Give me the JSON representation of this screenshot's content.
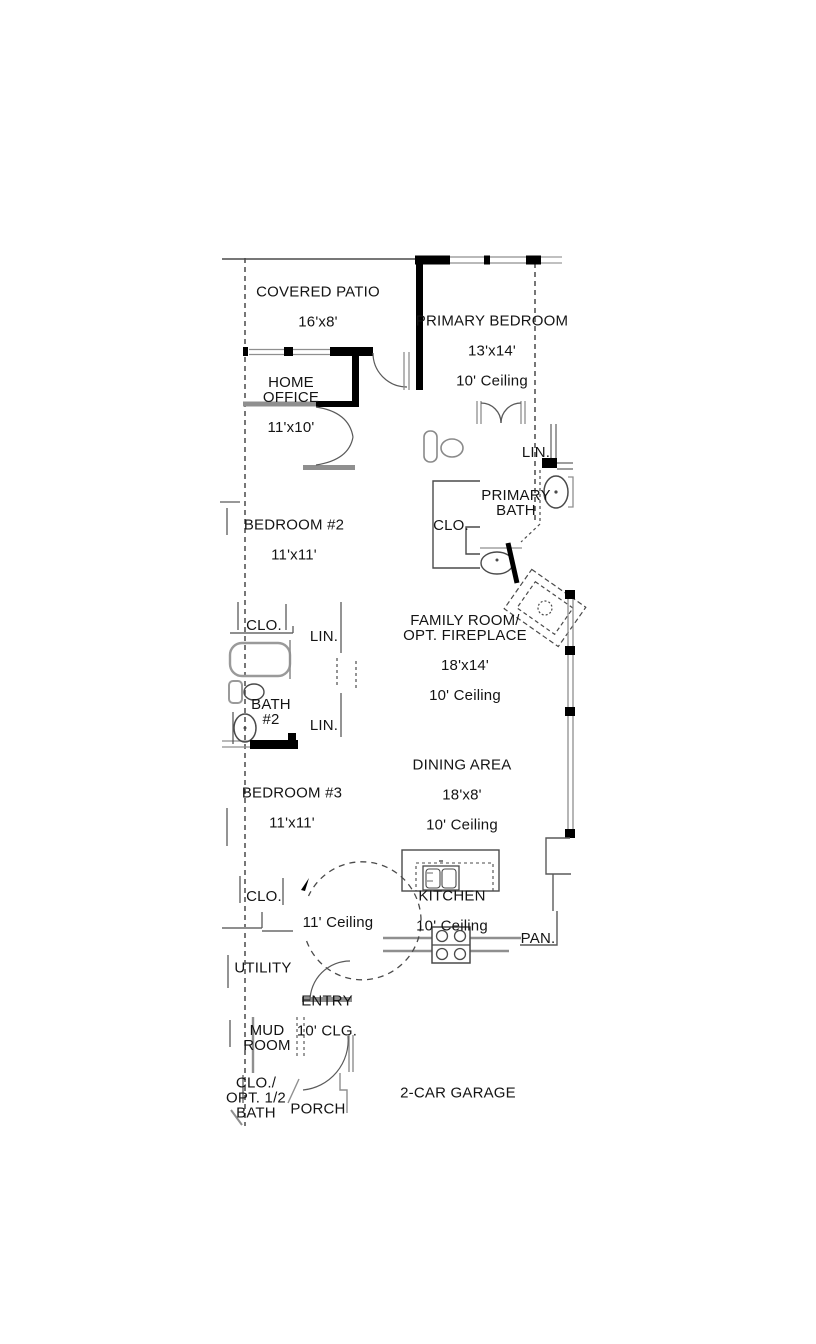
{
  "page": {
    "type": "residential floor plan",
    "background_color": "#ffffff",
    "wall_color": "#000000",
    "gray_wall_color": "#8f8f8f",
    "text_color": "#141414"
  },
  "floor_plan": {
    "rooms": {
      "covered_patio": {
        "name": "COVERED PATIO",
        "dims": "16'x8'"
      },
      "primary_bedroom": {
        "name": "PRIMARY BEDROOM",
        "dims": "13'x14'",
        "ceiling": "10' Ceiling"
      },
      "home_office": {
        "name": "HOME\nOFFICE",
        "dims": "11'x10'"
      },
      "primary_bath": {
        "name": "PRIMARY\nBATH"
      },
      "bedroom_2": {
        "name": "BEDROOM #2",
        "dims": "11'x11'"
      },
      "bath_2": {
        "name": "BATH\n#2"
      },
      "family_room": {
        "name": "FAMILY ROOM/\nOPT. FIREPLACE",
        "dims": "18'x14'",
        "ceiling": "10' Ceiling"
      },
      "dining_area": {
        "name": "DINING AREA",
        "dims": "18'x8'",
        "ceiling": "10' Ceiling"
      },
      "bedroom_3": {
        "name": "BEDROOM #3",
        "dims": "11'x11'"
      },
      "kitchen": {
        "name": "KITCHEN",
        "ceiling": "10' Ceiling"
      },
      "rotunda": {
        "ceiling": "11' Ceiling"
      },
      "utility": {
        "name": "UTILITY"
      },
      "entry": {
        "name": "ENTRY",
        "ceiling": "10' CLG."
      },
      "mud_room": {
        "name": "MUD\nROOM"
      },
      "opt_half_bath": {
        "name": "CLO./\nOPT. 1/2\nBATH"
      },
      "porch": {
        "name": "PORCH"
      },
      "garage": {
        "name": "2-CAR GARAGE"
      },
      "pantry": {
        "name": "PAN."
      }
    },
    "storage_labels": {
      "primary_linen": "LIN.",
      "primary_closet": "CLO.",
      "bedroom2_closet": "CLO.",
      "hall_linen_upper": "LIN.",
      "hall_linen_lower": "LIN.",
      "bedroom3_closet": "CLO."
    }
  }
}
